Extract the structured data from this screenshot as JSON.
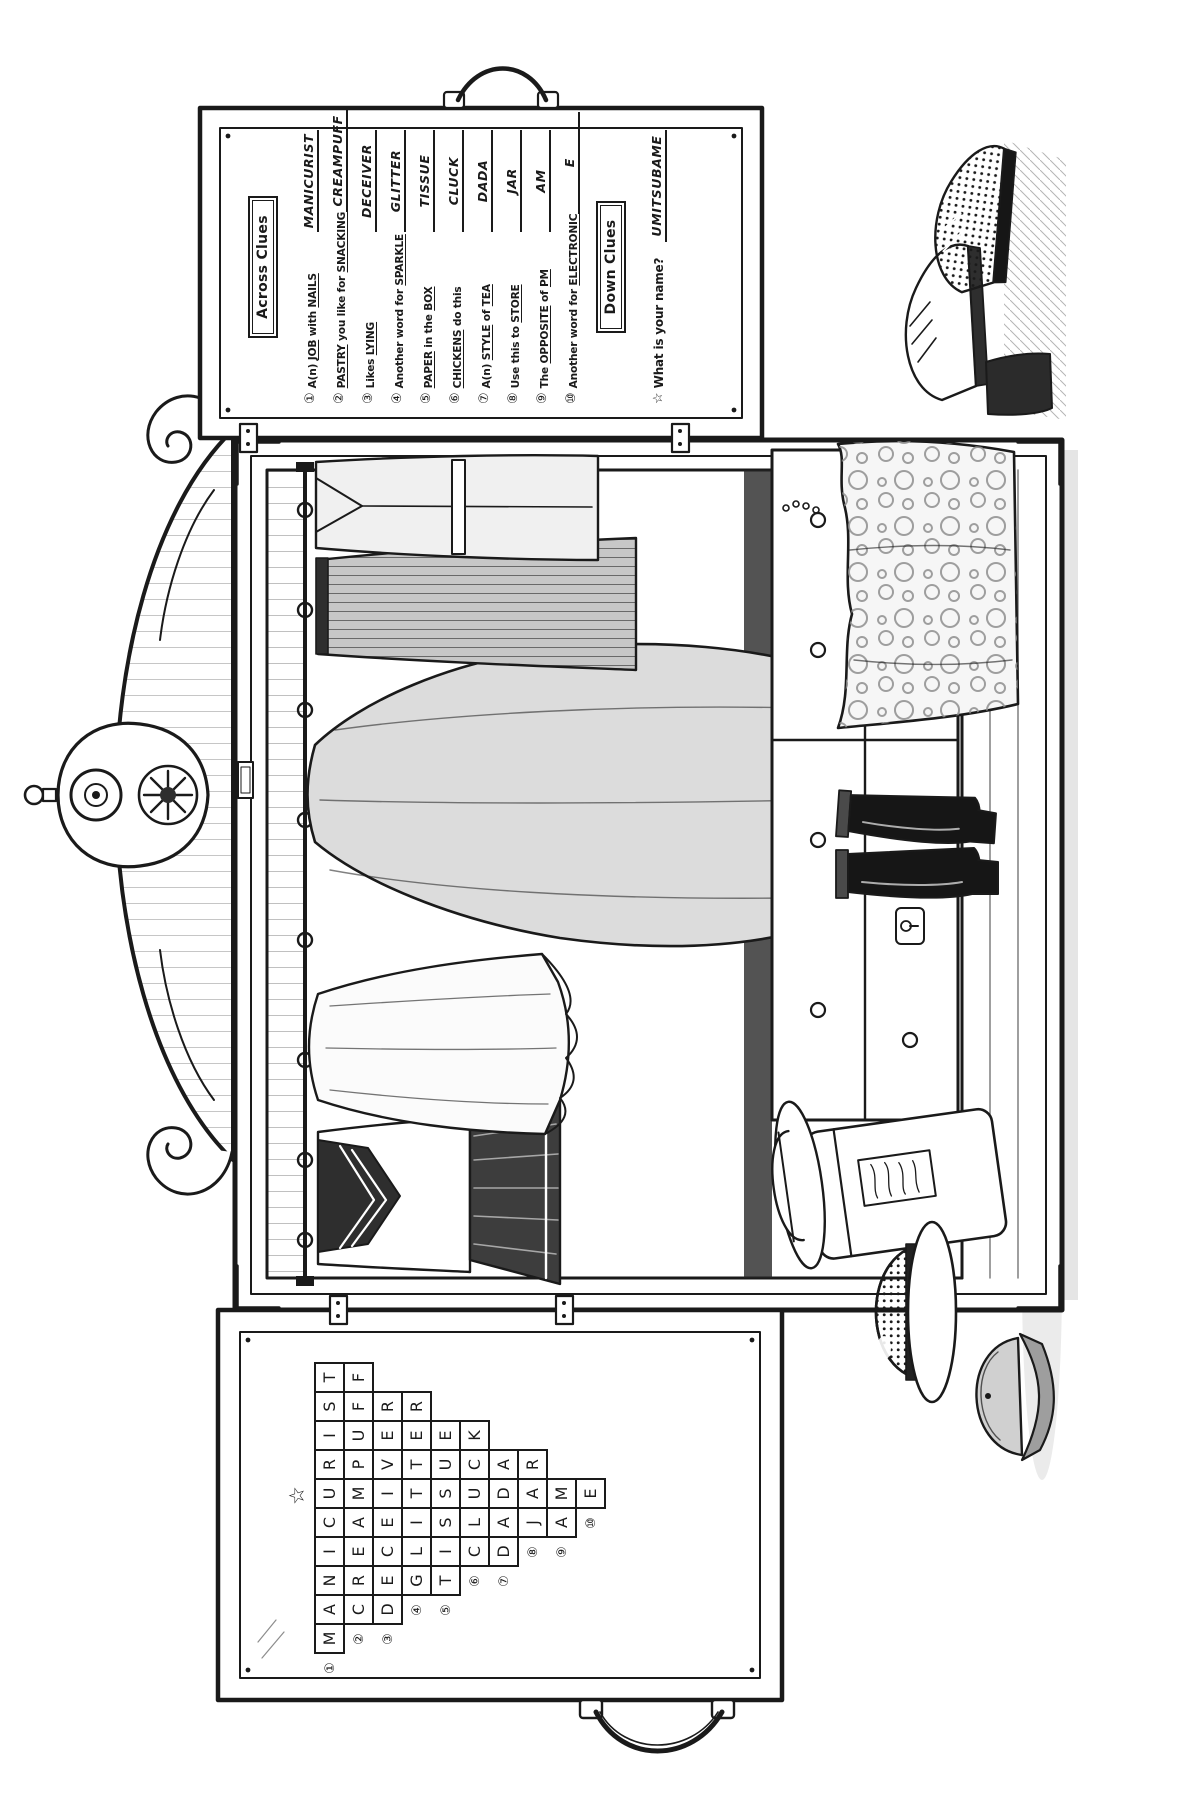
{
  "across": {
    "title": "Across Clues",
    "clues": [
      {
        "num": "①",
        "text": "A(n) _JOB_ with _NAILS_",
        "answer": "MANICURIST"
      },
      {
        "num": "②",
        "text": "_PASTRY_ you like for _SNACKING_",
        "answer": "CREAMPUFF"
      },
      {
        "num": "③",
        "text": "Likes _LYING_",
        "answer": "DECEIVER"
      },
      {
        "num": "④",
        "text": "Another word for _SPARKLE_",
        "answer": "GLITTER"
      },
      {
        "num": "⑤",
        "text": "_PAPER_ in the _BOX_",
        "answer": "TISSUE"
      },
      {
        "num": "⑥",
        "text": "_CHICKENS_ do this",
        "answer": "CLUCK"
      },
      {
        "num": "⑦",
        "text": "A(n) _STYLE_ of _TEA_",
        "answer": "DADA"
      },
      {
        "num": "⑧",
        "text": "Use this to _STORE_",
        "answer": "JAR"
      },
      {
        "num": "⑨",
        "text": "The _OPPOSITE_ of _PM_",
        "answer": "AM"
      },
      {
        "num": "⑩",
        "text": "Another word for _ELECTRONIC_",
        "answer": "E"
      }
    ]
  },
  "down": {
    "title": "Down Clues",
    "clues": [
      {
        "num": "☆",
        "text": "What is your name?",
        "answer": "UMITSUBAME"
      }
    ]
  },
  "grid": {
    "star": "☆",
    "star_col": 5,
    "rows": [
      {
        "num": "①",
        "word": "MANICURIST",
        "offset": 0
      },
      {
        "num": "②",
        "word": "CREAMPUFF",
        "offset": 1
      },
      {
        "num": "③",
        "word": "DECEIVER",
        "offset": 1
      },
      {
        "num": "④",
        "word": "GLITTER",
        "offset": 2
      },
      {
        "num": "⑤",
        "word": "TISSUE",
        "offset": 2
      },
      {
        "num": "⑥",
        "word": "CLUCK",
        "offset": 3
      },
      {
        "num": "⑦",
        "word": "DADA",
        "offset": 3
      },
      {
        "num": "⑧",
        "word": "JAR",
        "offset": 4
      },
      {
        "num": "⑨",
        "word": "AM",
        "offset": 4
      },
      {
        "num": "⑩",
        "word": "E",
        "offset": 5
      }
    ]
  },
  "colors": {
    "ink": "#1a1a1a",
    "paper": "#ffffff",
    "tone_light": "#e6e6e6",
    "tone_mid": "#cfcfcf",
    "tone_dark": "#2e2e2e"
  }
}
